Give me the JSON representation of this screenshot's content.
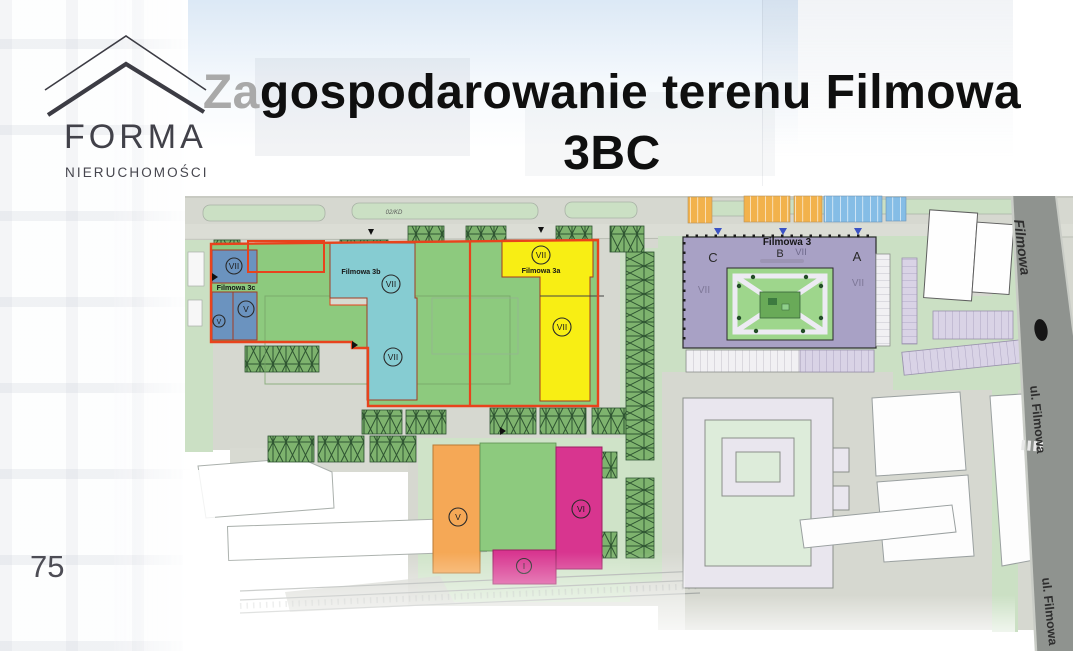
{
  "slide": {
    "page_number": "75"
  },
  "logo": {
    "name": "FORMA",
    "subtitle": "NIERUCHOMOŚCI"
  },
  "title": {
    "prefix": "Za",
    "line1_rest": "gospodarowanie terenu Filmowa",
    "line2": "3BC"
  },
  "map": {
    "labels": {
      "plot_c": "Filmowa 3c",
      "plot_b": "Filmowa 3b",
      "plot_a": "Filmowa 3a",
      "complex": "Filmowa 3",
      "wing_c": "C",
      "wing_b": "B",
      "wing_a": "A",
      "road_code": "02/KD",
      "street_italic": "Filmowa",
      "street_mid": "ul. Filmowa",
      "street_bottom": "ul. Filmowa"
    },
    "storeys": {
      "seven": "VII",
      "six": "VI",
      "five": "V",
      "one": "I"
    },
    "colors": {
      "plot_outline": "#e8431c",
      "building_filmowa_3c": "#6b93bf",
      "building_filmowa_3b": "#86ccd2",
      "building_filmowa_3a": "#f8ee14",
      "building_filmowa_3": "#a8a1c5",
      "building_pink": "#d8358f",
      "building_orange": "#f5a856",
      "lawn": "#8dca7e",
      "green_light": "#cbe0c4",
      "courtyard": "#9ed68c",
      "road_light": "#d6d8d0",
      "road_dark": "#8f938f",
      "parking_orange": "#f2b24c",
      "parking_blue": "#85bde6",
      "parking_lavender": "#d9d3e6"
    }
  }
}
